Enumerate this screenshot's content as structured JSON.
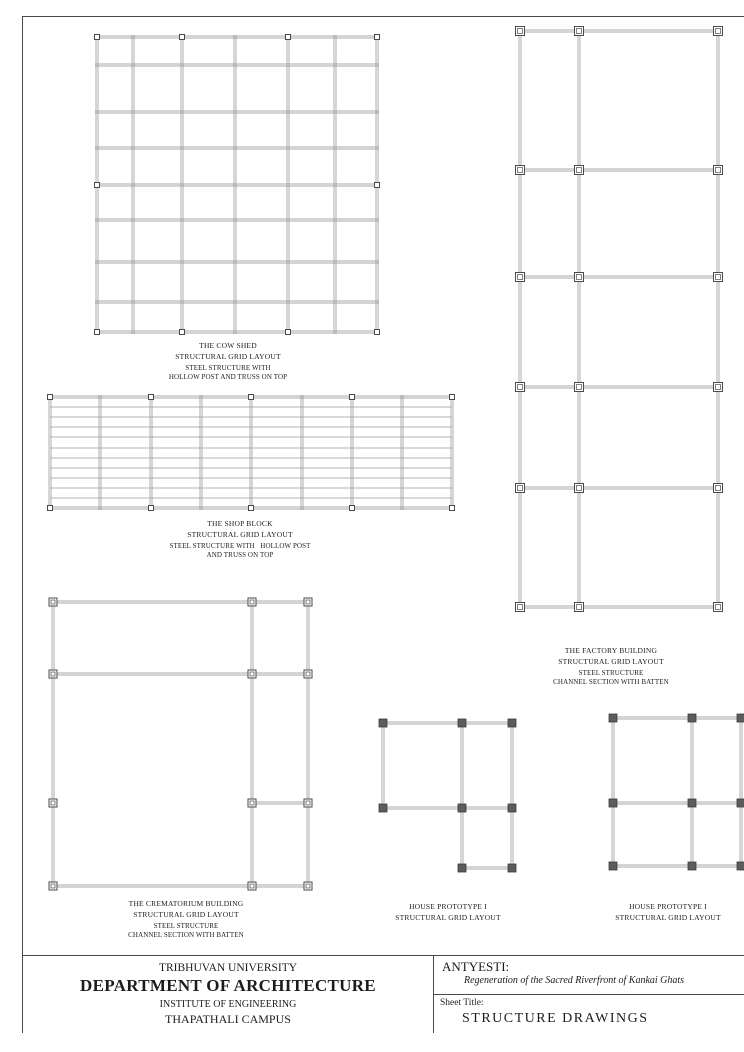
{
  "colors": {
    "grid_line": "#8c8c8c",
    "grid_single": "#9a9a9a",
    "marker_outline": "#4a4a4a",
    "marker_fill_dark": "#5c5c5c",
    "sheet_border": "#4a4a4a",
    "text": "#1c1c1c"
  },
  "drawings": [
    {
      "id": "cow-shed",
      "frame": {
        "x": 97,
        "y": 37,
        "w": 280,
        "h": 295
      },
      "style": {
        "marker": "open",
        "msize": 5,
        "overhang": 2
      },
      "vlines": [
        [
          0
        ],
        [
          36
        ],
        [
          85
        ],
        [
          138
        ],
        [
          191
        ],
        [
          238
        ],
        [
          280
        ]
      ],
      "hlines": [
        [
          0
        ],
        [
          28
        ],
        [
          75
        ],
        [
          111
        ],
        [
          148
        ],
        [
          183
        ],
        [
          225
        ],
        [
          265
        ],
        [
          295
        ]
      ],
      "hsingles": [],
      "markers": [
        [
          0,
          0
        ],
        [
          85,
          0
        ],
        [
          191,
          0
        ],
        [
          280,
          0
        ],
        [
          0,
          148
        ],
        [
          280,
          148
        ],
        [
          0,
          295
        ],
        [
          85,
          295
        ],
        [
          191,
          295
        ],
        [
          280,
          295
        ]
      ],
      "label": {
        "cx": 228,
        "top": 340,
        "lines": [
          "THE COW SHED",
          "STRUCTURAL GRID LAYOUT"
        ],
        "sublines": [
          "STEEL STRUCTURE WITH",
          "HOLLOW POST AND TRUSS ON TOP"
        ]
      }
    },
    {
      "id": "shop-block",
      "frame": {
        "x": 50,
        "y": 397,
        "w": 402,
        "h": 111
      },
      "style": {
        "marker": "open",
        "msize": 5,
        "overhang": 2
      },
      "vlines": [
        [
          0
        ],
        [
          50
        ],
        [
          101
        ],
        [
          151
        ],
        [
          201
        ],
        [
          252
        ],
        [
          302
        ],
        [
          352
        ],
        [
          402
        ]
      ],
      "hlines": [
        [
          0
        ],
        [
          111
        ]
      ],
      "hsingles": [
        [
          10
        ],
        [
          20
        ],
        [
          30
        ],
        [
          40
        ],
        [
          51
        ],
        [
          61
        ],
        [
          71
        ],
        [
          81
        ],
        [
          91
        ],
        [
          101
        ]
      ],
      "markers": [
        [
          0,
          0
        ],
        [
          101,
          0
        ],
        [
          201,
          0
        ],
        [
          302,
          0
        ],
        [
          402,
          0
        ],
        [
          0,
          111
        ],
        [
          101,
          111
        ],
        [
          201,
          111
        ],
        [
          302,
          111
        ],
        [
          402,
          111
        ]
      ],
      "label": {
        "cx": 240,
        "top": 518,
        "lines": [
          "THE SHOP BLOCK",
          "STRUCTURAL GRID LAYOUT"
        ],
        "sublines": [
          "STEEL STRUCTURE WITH   HOLLOW POST",
          "AND TRUSS ON TOP"
        ]
      }
    },
    {
      "id": "factory-building",
      "frame": {
        "x": 520,
        "y": 31,
        "w": 198,
        "h": 576
      },
      "style": {
        "marker": "open",
        "msize": 9,
        "overhang": 4
      },
      "vlines": [
        [
          0
        ],
        [
          59
        ],
        [
          198
        ]
      ],
      "hlines": [
        [
          0
        ],
        [
          139
        ],
        [
          246
        ],
        [
          356
        ],
        [
          457
        ],
        [
          576
        ]
      ],
      "hsingles": [],
      "markers": [
        [
          0,
          0
        ],
        [
          59,
          0
        ],
        [
          198,
          0
        ],
        [
          0,
          139
        ],
        [
          59,
          139
        ],
        [
          198,
          139
        ],
        [
          0,
          246
        ],
        [
          59,
          246
        ],
        [
          198,
          246
        ],
        [
          0,
          356
        ],
        [
          59,
          356
        ],
        [
          198,
          356
        ],
        [
          0,
          457
        ],
        [
          59,
          457
        ],
        [
          198,
          457
        ],
        [
          0,
          576
        ],
        [
          59,
          576
        ],
        [
          198,
          576
        ]
      ],
      "label": {
        "cx": 611,
        "top": 645,
        "lines": [
          "THE FACTORY BUILDING",
          "STRUCTURAL GRID LAYOUT"
        ],
        "sublines": [
          "STEEL STRUCTURE",
          "CHANNEL SECTION WITH BATTEN"
        ]
      }
    },
    {
      "id": "crematorium-building",
      "frame": {
        "x": 53,
        "y": 602,
        "w": 255,
        "h": 284
      },
      "style": {
        "marker": "open",
        "msize": 8,
        "overhang": 4
      },
      "vlines": [
        [
          0
        ],
        [
          199
        ],
        [
          255
        ]
      ],
      "hlines": [
        [
          0
        ],
        [
          72
        ],
        [
          201,
          199,
          255
        ],
        [
          284
        ]
      ],
      "hsingles": [],
      "markers": [
        [
          0,
          0
        ],
        [
          199,
          0
        ],
        [
          255,
          0
        ],
        [
          0,
          72
        ],
        [
          199,
          72
        ],
        [
          255,
          72
        ],
        [
          0,
          201
        ],
        [
          199,
          201
        ],
        [
          255,
          201
        ],
        [
          0,
          284
        ],
        [
          199,
          284
        ],
        [
          255,
          284
        ]
      ],
      "label": {
        "cx": 186,
        "top": 898,
        "lines": [
          "THE CREMATORIUM BUILDING",
          "STRUCTURAL GRID LAYOUT"
        ],
        "sublines": [
          "STEEL STRUCTURE",
          "CHANNEL SECTION WITH BATTEN"
        ]
      }
    },
    {
      "id": "house-prototype-left",
      "frame": {
        "x": 383,
        "y": 723,
        "w": 129,
        "h": 145
      },
      "style": {
        "marker": "filled",
        "msize": 8,
        "overhang": 4
      },
      "vlines": [
        [
          0,
          0,
          85
        ],
        [
          79
        ],
        [
          129
        ]
      ],
      "hlines": [
        [
          0
        ],
        [
          85
        ],
        [
          145,
          79,
          129
        ]
      ],
      "hsingles": [],
      "markers": [
        [
          0,
          0
        ],
        [
          79,
          0
        ],
        [
          129,
          0
        ],
        [
          0,
          85
        ],
        [
          79,
          85
        ],
        [
          129,
          85
        ],
        [
          79,
          145
        ],
        [
          129,
          145
        ]
      ],
      "label": {
        "cx": 448,
        "top": 901,
        "lines": [
          "HOUSE PROTOTYPE I",
          "STRUCTURAL GRID LAYOUT"
        ],
        "sublines": []
      }
    },
    {
      "id": "house-prototype-right",
      "frame": {
        "x": 613,
        "y": 718,
        "w": 128,
        "h": 148
      },
      "style": {
        "marker": "filled",
        "msize": 8,
        "overhang": 4
      },
      "vlines": [
        [
          0
        ],
        [
          79
        ],
        [
          128
        ]
      ],
      "hlines": [
        [
          0
        ],
        [
          85
        ],
        [
          148
        ]
      ],
      "hsingles": [],
      "markers": [
        [
          0,
          0
        ],
        [
          79,
          0
        ],
        [
          128,
          0
        ],
        [
          0,
          85
        ],
        [
          79,
          85
        ],
        [
          128,
          85
        ],
        [
          0,
          148
        ],
        [
          79,
          148
        ],
        [
          128,
          148
        ]
      ],
      "label": {
        "cx": 668,
        "top": 901,
        "lines": [
          "HOUSE PROTOTYPE I",
          "STRUCTURAL GRID LAYOUT"
        ],
        "sublines": []
      }
    }
  ],
  "titleblock": {
    "university": "TRIBHUVAN UNIVERSITY",
    "department": "DEPARTMENT OF ARCHITECTURE",
    "institute": "INSTITUTE OF ENGINEERING",
    "campus": "THAPATHALI CAMPUS",
    "project": "ANTYESTI:",
    "project_subtitle": "Regeneration of the Sacred Riverfront of Kankai Ghats",
    "sheet_label": "Sheet Title:",
    "sheet_title": "STRUCTURE DRAWINGS"
  }
}
